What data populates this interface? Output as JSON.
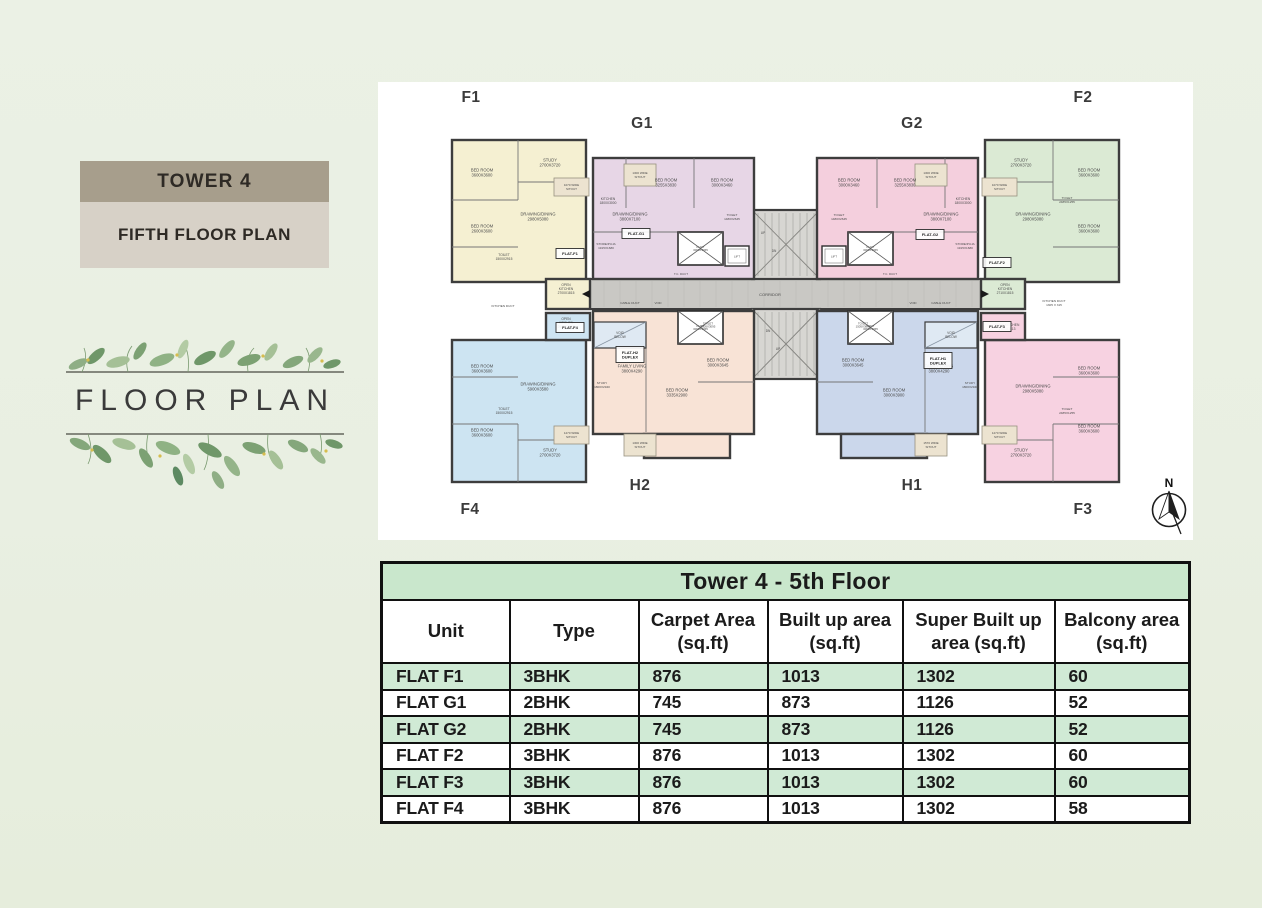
{
  "sidebar": {
    "tower_label": "TOWER 4",
    "floor_label": "FIFTH FLOOR PLAN",
    "emblem_title": "FLOOR PLAN"
  },
  "plan": {
    "canvas_bg": "#ffffff",
    "wall_color": "#3d3d3d",
    "corridor_color": "#c9c8c4",
    "compass": {
      "letter": "N"
    },
    "unit_labels": [
      {
        "t": "F1",
        "x": 93,
        "y": 20
      },
      {
        "t": "G1",
        "x": 264,
        "y": 46
      },
      {
        "t": "G2",
        "x": 534,
        "y": 46
      },
      {
        "t": "F2",
        "x": 705,
        "y": 20
      },
      {
        "t": "F4",
        "x": 92,
        "y": 432
      },
      {
        "t": "H2",
        "x": 262,
        "y": 408
      },
      {
        "t": "H1",
        "x": 534,
        "y": 408
      },
      {
        "t": "F3",
        "x": 705,
        "y": 432
      }
    ],
    "units": [
      {
        "id": "F1",
        "color": "#f5f0d2",
        "rects": [
          [
            74,
            58,
            134,
            142
          ],
          [
            168,
            197,
            44,
            30
          ]
        ],
        "lines": [
          [
            140,
            58,
            140,
            118
          ],
          [
            74,
            118,
            140,
            118
          ],
          [
            140,
            100,
            208,
            100
          ],
          [
            74,
            165,
            140,
            165
          ]
        ]
      },
      {
        "id": "G1",
        "color": "#e7d6e6",
        "rects": [
          [
            215,
            76,
            161,
            121
          ]
        ],
        "lines": [
          [
            248,
            76,
            248,
            126
          ],
          [
            316,
            76,
            316,
            126
          ],
          [
            215,
            150,
            300,
            150
          ]
        ]
      },
      {
        "id": "G2",
        "color": "#f4cfdd",
        "rects": [
          [
            439,
            76,
            161,
            121
          ]
        ],
        "lines": [
          [
            567,
            76,
            567,
            126
          ],
          [
            499,
            76,
            499,
            126
          ],
          [
            515,
            150,
            600,
            150
          ]
        ]
      },
      {
        "id": "F2",
        "color": "#dbead4",
        "rects": [
          [
            607,
            58,
            134,
            142
          ],
          [
            603,
            197,
            44,
            30
          ]
        ],
        "lines": [
          [
            675,
            58,
            675,
            118
          ],
          [
            675,
            118,
            741,
            118
          ],
          [
            607,
            100,
            675,
            100
          ],
          [
            675,
            165,
            741,
            165
          ]
        ]
      },
      {
        "id": "F4",
        "color": "#cde4f2",
        "rects": [
          [
            74,
            258,
            134,
            142
          ],
          [
            168,
            231,
            44,
            27
          ]
        ],
        "lines": [
          [
            140,
            342,
            140,
            400
          ],
          [
            74,
            342,
            140,
            342
          ],
          [
            140,
            358,
            208,
            358
          ],
          [
            74,
            295,
            140,
            295
          ]
        ]
      },
      {
        "id": "H2",
        "color": "#f8e3d6",
        "rects": [
          [
            215,
            229,
            161,
            123
          ],
          [
            266,
            352,
            86,
            24
          ]
        ],
        "lines": [
          [
            268,
            266,
            268,
            350
          ],
          [
            320,
            300,
            376,
            300
          ]
        ]
      },
      {
        "id": "H1",
        "color": "#cbd7eb",
        "rects": [
          [
            439,
            229,
            161,
            123
          ],
          [
            463,
            352,
            86,
            24
          ]
        ],
        "lines": [
          [
            547,
            266,
            547,
            350
          ],
          [
            439,
            300,
            495,
            300
          ]
        ]
      },
      {
        "id": "F3",
        "color": "#f7d2e1",
        "rects": [
          [
            607,
            258,
            134,
            142
          ],
          [
            603,
            231,
            44,
            27
          ]
        ],
        "lines": [
          [
            675,
            342,
            675,
            400
          ],
          [
            675,
            342,
            741,
            342
          ],
          [
            607,
            358,
            675,
            358
          ],
          [
            675,
            295,
            741,
            295
          ]
        ]
      }
    ],
    "corridor": {
      "rect": [
        212,
        197,
        391,
        30
      ],
      "label": "CORRIDOR"
    },
    "stairs": [
      [
        374,
        128,
        68,
        69
      ],
      [
        374,
        227,
        68,
        70
      ]
    ],
    "ducts": [
      {
        "rect": [
          300,
          150,
          45,
          33
        ],
        "t": "DUCT\n3000X3065"
      },
      {
        "rect": [
          470,
          150,
          45,
          33
        ],
        "t": "DUCT\n3000X3065"
      },
      {
        "rect": [
          300,
          229,
          45,
          33
        ],
        "t": "DUCT\n3000X3065"
      },
      {
        "rect": [
          470,
          229,
          45,
          33
        ],
        "t": "DUCT\n3000X3065"
      }
    ],
    "lifts": [
      {
        "rect": [
          347,
          164,
          24,
          20
        ],
        "t": "LIFT"
      },
      {
        "rect": [
          444,
          164,
          24,
          20
        ],
        "t": "LIFT"
      }
    ],
    "voids": [
      {
        "rect": [
          216,
          240,
          52,
          26
        ],
        "t": "VOID\nBELOW"
      },
      {
        "rect": [
          547,
          240,
          52,
          26
        ],
        "t": "VOID\nBELOW"
      }
    ],
    "sitouts": [
      {
        "rect": [
          176,
          96,
          35,
          18
        ],
        "t": "1070 WIDE\nSITOUT"
      },
      {
        "rect": [
          246,
          82,
          32,
          22
        ],
        "t": "1300 WIDE\nSITOUT"
      },
      {
        "rect": [
          537,
          82,
          32,
          22
        ],
        "t": "1300 WIDE\nSITOUT"
      },
      {
        "rect": [
          604,
          96,
          35,
          18
        ],
        "t": "1070 WIDE\nSITOUT"
      },
      {
        "rect": [
          176,
          344,
          35,
          18
        ],
        "t": "1270 WIDE\nSITOUT"
      },
      {
        "rect": [
          246,
          352,
          32,
          22
        ],
        "t": "1300 WIDE\nSITOUT"
      },
      {
        "rect": [
          537,
          352,
          32,
          22
        ],
        "t": "1570 WIDE\nSITOUT"
      },
      {
        "rect": [
          604,
          344,
          35,
          18
        ],
        "t": "1270 WIDE\nSITOUT"
      }
    ],
    "labels": [
      {
        "t": "BED ROOM\n3600X3600",
        "x": 104,
        "y": 92
      },
      {
        "t": "STUDY\n2700X3720",
        "x": 172,
        "y": 82
      },
      {
        "t": "BED ROOM\n2600X3600",
        "x": 104,
        "y": 148
      },
      {
        "t": "DRAWING/DINING\n2980X5080",
        "x": 160,
        "y": 136
      },
      {
        "t": "TOILET\n1500X2915",
        "x": 126,
        "y": 176,
        "s": 3.3
      },
      {
        "t": "OPEN\nKITCHEN\n2700X1815",
        "x": 188,
        "y": 208,
        "s": 3.3
      },
      {
        "t": "BED ROOM\n3255X3830",
        "x": 288,
        "y": 102
      },
      {
        "t": "BED ROOM\n3000X3460",
        "x": 344,
        "y": 102
      },
      {
        "t": "KITCHEN\n1800X3000",
        "x": 230,
        "y": 120,
        "s": 3.3
      },
      {
        "t": "DRAWING/DINING\n3800X7100",
        "x": 252,
        "y": 136
      },
      {
        "t": "STORE/PUJA\n1915X1680",
        "x": 228,
        "y": 165,
        "s": 3.1
      },
      {
        "t": "TOILET\n1480X2645",
        "x": 354,
        "y": 136,
        "s": 3.1
      },
      {
        "t": "BED ROOM\n3000X3460",
        "x": 471,
        "y": 102
      },
      {
        "t": "BED ROOM\n3255X3830",
        "x": 527,
        "y": 102
      },
      {
        "t": "KITCHEN\n1800X3000",
        "x": 585,
        "y": 120,
        "s": 3.3
      },
      {
        "t": "DRAWING/DINING\n3800X7100",
        "x": 563,
        "y": 136
      },
      {
        "t": "STORE/PUJA\n1915X1680",
        "x": 587,
        "y": 165,
        "s": 3.1
      },
      {
        "t": "TOILET\n1480X2645",
        "x": 461,
        "y": 136,
        "s": 3.1
      },
      {
        "t": "STUDY\n2700X3720",
        "x": 643,
        "y": 82
      },
      {
        "t": "BED ROOM\n3600X3600",
        "x": 711,
        "y": 92
      },
      {
        "t": "BED ROOM\n3600X3600",
        "x": 711,
        "y": 148
      },
      {
        "t": "DRAWING/DINING\n2980X5080",
        "x": 655,
        "y": 136
      },
      {
        "t": "TOILET\n2485X1255",
        "x": 689,
        "y": 119,
        "s": 3.1
      },
      {
        "t": "OPEN\nKITCHEN\n2710X1815",
        "x": 627,
        "y": 208,
        "s": 3.3
      },
      {
        "t": "BED ROOM\n3600X3600",
        "x": 104,
        "y": 288
      },
      {
        "t": "OPEN\nKITCHEN\n2900X1815",
        "x": 188,
        "y": 242,
        "s": 3.3
      },
      {
        "t": "DRAWING/DINING\n5900X3580",
        "x": 160,
        "y": 306
      },
      {
        "t": "BED ROOM\n3600X3600",
        "x": 104,
        "y": 352
      },
      {
        "t": "STUDY\n2700X3720",
        "x": 172,
        "y": 372
      },
      {
        "t": "TOILET\n1500X2915",
        "x": 126,
        "y": 330,
        "s": 3.3
      },
      {
        "t": "FAMILY LIVING\n3800X4290",
        "x": 254,
        "y": 288
      },
      {
        "t": "STUDY\n1800X2940",
        "x": 224,
        "y": 304,
        "s": 3.1
      },
      {
        "t": "BED ROOM\n3335X2900",
        "x": 299,
        "y": 312
      },
      {
        "t": "BED ROOM\n3000X3645",
        "x": 340,
        "y": 282
      },
      {
        "t": "TOILET\n1505X3095",
        "x": 330,
        "y": 244,
        "s": 2.9
      },
      {
        "t": "FAMILY LIVING\n3800X4290",
        "x": 561,
        "y": 288
      },
      {
        "t": "STUDY\n1800X2940",
        "x": 592,
        "y": 304,
        "s": 3.1
      },
      {
        "t": "BED ROOM\n3000X3900",
        "x": 516,
        "y": 312
      },
      {
        "t": "BED ROOM\n3000X3645",
        "x": 475,
        "y": 282
      },
      {
        "t": "TOILET\n1505X3095",
        "x": 485,
        "y": 244,
        "s": 2.9
      },
      {
        "t": "OPEN KITCHEN\n2700X1813",
        "x": 629,
        "y": 246,
        "s": 3.3
      },
      {
        "t": "DRAWING/DINING\n2980X5080",
        "x": 655,
        "y": 308
      },
      {
        "t": "BED ROOM\n3600X3600",
        "x": 711,
        "y": 290
      },
      {
        "t": "BED ROOM\n3600X3600",
        "x": 711,
        "y": 348
      },
      {
        "t": "STUDY\n2700X3720",
        "x": 643,
        "y": 372
      },
      {
        "t": "TOILET\n2485X1255",
        "x": 689,
        "y": 330,
        "s": 3.1
      },
      {
        "t": "CORRIDOR",
        "x": 392,
        "y": 214,
        "s": 4.0
      },
      {
        "t": "CABLE DUCT",
        "x": 252,
        "y": 222,
        "s": 3.1
      },
      {
        "t": "VOID",
        "x": 280,
        "y": 222,
        "s": 2.9
      },
      {
        "t": "VOID",
        "x": 535,
        "y": 222,
        "s": 2.9
      },
      {
        "t": "CABLE DUCT",
        "x": 563,
        "y": 222,
        "s": 3.1
      },
      {
        "t": "T.C. DUCT",
        "x": 303,
        "y": 193,
        "s": 2.9
      },
      {
        "t": "T.C. DUCT",
        "x": 512,
        "y": 193,
        "s": 2.9
      },
      {
        "t": "UP",
        "x": 385,
        "y": 152,
        "s": 3.2
      },
      {
        "t": "DN",
        "x": 396,
        "y": 170,
        "s": 3.2
      },
      {
        "t": "DN",
        "x": 390,
        "y": 250,
        "s": 3.2
      },
      {
        "t": "UP",
        "x": 400,
        "y": 268,
        "s": 3.2
      },
      {
        "t": "KITCHEN DUCT",
        "x": 125,
        "y": 225,
        "s": 3.1
      },
      {
        "t": "KITCHEN DUCT\n1305 X 315",
        "x": 676,
        "y": 222,
        "s": 3.1
      }
    ],
    "badges": [
      {
        "t": "FLAT-F1",
        "x": 192,
        "y": 172,
        "w": 28,
        "h": 8
      },
      {
        "t": "FLAT-G1",
        "x": 258,
        "y": 152,
        "w": 28,
        "h": 8
      },
      {
        "t": "FLAT-G2",
        "x": 552,
        "y": 153,
        "w": 28,
        "h": 8
      },
      {
        "t": "FLAT-F2",
        "x": 619,
        "y": 181,
        "w": 28,
        "h": 8
      },
      {
        "t": "FLAT-F4",
        "x": 192,
        "y": 246,
        "w": 28,
        "h": 8
      },
      {
        "t": "FLAT-H2\nDUPLEX",
        "x": 252,
        "y": 273,
        "w": 28,
        "h": 14
      },
      {
        "t": "FLAT-H1\nDUPLEX",
        "x": 560,
        "y": 279,
        "w": 28,
        "h": 14
      },
      {
        "t": "FLAT-F3",
        "x": 619,
        "y": 245,
        "w": 28,
        "h": 8
      }
    ]
  },
  "table": {
    "title": "Tower 4 - 5th Floor",
    "columns": [
      "Unit",
      "Type",
      "Carpet Area\n(sq.ft)",
      "Built up area\n(sq.ft)",
      "Super Built up\narea (sq.ft)",
      "Balcony area\n(sq.ft)"
    ],
    "rows": [
      [
        "FLAT F1",
        "3BHK",
        "876",
        "1013",
        "1302",
        "60"
      ],
      [
        "FLAT G1",
        "2BHK",
        "745",
        "873",
        "1126",
        "52"
      ],
      [
        "FLAT G2",
        "2BHK",
        "745",
        "873",
        "1126",
        "52"
      ],
      [
        "FLAT F2",
        "3BHK",
        "876",
        "1013",
        "1302",
        "60"
      ],
      [
        "FLAT F3",
        "3BHK",
        "876",
        "1013",
        "1302",
        "60"
      ],
      [
        "FLAT F4",
        "3BHK",
        "876",
        "1013",
        "1302",
        "58"
      ]
    ],
    "colors": {
      "title_bg": "#c9e7cc",
      "row_green": "#d0ead5",
      "border": "#101010"
    }
  }
}
